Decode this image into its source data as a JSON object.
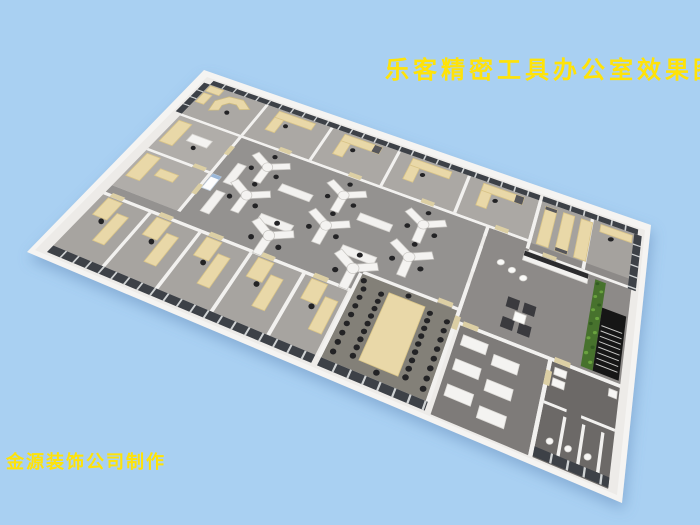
{
  "scene": {
    "background": "#a9d0f2"
  },
  "title": {
    "text": "乐客精密工具办公室效果图",
    "color": "#ffe308"
  },
  "credit": {
    "text": "金源装饰公司制作",
    "color": "#ffe308"
  },
  "palette": {
    "slab": "#f5f4f2",
    "wall": "#f2f1ef",
    "wallTop": "#edebe8",
    "glass": "#3d4147",
    "mullion": "#d0d3d4",
    "floorOpen": "#949290",
    "floorOffice": "#aba8a4",
    "floorLeft": "#b0ada9",
    "floorRowOffice": "#a7a4a0",
    "floorRight": "#8d8a88",
    "floorMeeting": "#838078",
    "floorStorageBR": "#7e7b79",
    "floorRestroom": "#6c6967",
    "woodLight": "#e9d8a8",
    "woodMid": "#d9c488",
    "deskWhite": "#f4f3f1",
    "cabinetWhite": "#f2f1ef",
    "chair": "#232325",
    "sofa": "#3a3a3e",
    "plant": "#47722d",
    "plantLight": "#6aa23f",
    "stairs": "#161616",
    "acBlue": "#9ab7d8",
    "doorTan": "#dccfa4",
    "darkTop": "#56565a",
    "shadow": "#5b82b4"
  }
}
